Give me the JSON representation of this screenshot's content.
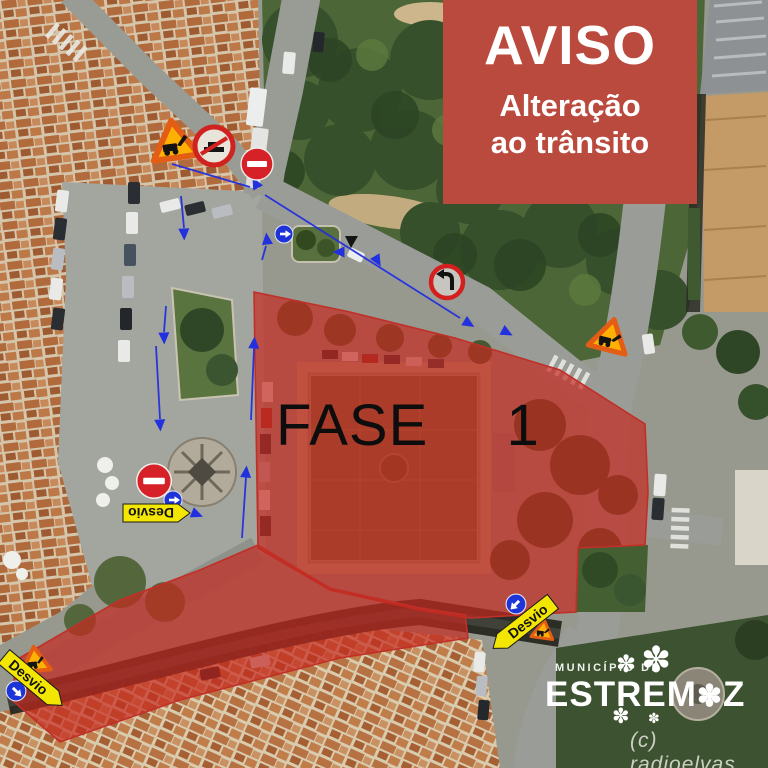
{
  "banner": {
    "title": "AVISO",
    "line1": "Alteração",
    "line2": "ao trânsito"
  },
  "phase_label": "FASE  1",
  "detour_label": "Desvio",
  "logo": {
    "muni": "MUNICÍPIO DE",
    "name_start": "ESTREM",
    "name_flower": "✽",
    "name_end": "Z"
  },
  "watermark": "(c) radioelvas",
  "colors": {
    "banner_bg": "#bb4a3e",
    "banner_text": "#ffffff",
    "zone_red": "#c5281e",
    "arrow_blue": "#2330dd",
    "detour_yellow": "#f3e603",
    "works_border_orange": "#e35d14",
    "works_fill_yellow": "#ffb103",
    "no_entry_red": "#d62128",
    "mandatory_blue": "#1d35d8",
    "phase_text": "#0d0d0d"
  },
  "icons": {
    "no_entry": "no-entry-sign",
    "roadworks": "roadworks-sign",
    "no_left_turn": "no-left-turn-sign",
    "prohibition": "no-parking-sign",
    "mandatory": "mandatory-direction-sign",
    "detour": "detour-arrow-sign",
    "direction_arrow": "direction-arrow",
    "flower": "flower-icon"
  }
}
